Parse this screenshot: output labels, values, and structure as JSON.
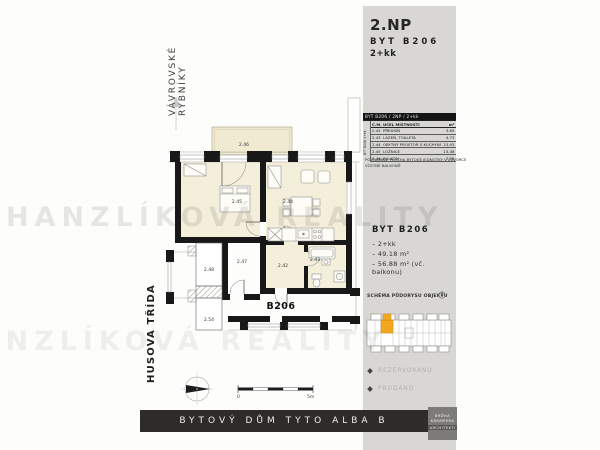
{
  "watermark": {
    "text": "HANZLÍKOVÁ REALITY"
  },
  "left": {
    "street_line1": "VÁVROVSKÉ",
    "street_line2": "RYBNÍKY",
    "street_bottom": "HUSOVA TŘÍDA"
  },
  "plan": {
    "unit_label": "B206",
    "labels": {
      "balcony": "2.46",
      "bedroom": "2.45",
      "living": "2.44",
      "hall": "2.42",
      "bath": "2.43",
      "neighbor1": "2.47",
      "neighbor2": "2.48",
      "neighbor3": "2.54"
    },
    "scale_start": "0",
    "scale_end": "5m"
  },
  "panel": {
    "floor": "2.NP",
    "unit": "BYT B206",
    "layout": "2+kk",
    "table": {
      "header_bar": "BYT B206 / 2NP / 2+kk",
      "side_label": "BYT B206 2+kk",
      "columns": {
        "num": "Č.M.",
        "name": "ÚČEL MÍSTNOSTI",
        "area": "m²"
      },
      "rows": [
        {
          "num": "2.42",
          "name": "PŘEDSÍŇ",
          "area": "3.85"
        },
        {
          "num": "2.43",
          "name": "LÁZEŇ, TOALETA",
          "area": "4.73"
        },
        {
          "num": "2.44",
          "name": "OBYTNÝ PROSTOR S KUCHYNÍ",
          "area": "23.92"
        },
        {
          "num": "2.45",
          "name": "LOŽNICE",
          "area": "13.48"
        },
        {
          "num": "2.46",
          "name": "BALKON",
          "area": "7.70"
        }
      ],
      "note1": "POZNÁMKA: PLOCHA BYTOVÉ JEDNOTKY V ZÁVORCE",
      "note2": "VČETNĚ BALKONŮ"
    },
    "summary": {
      "title": "BYT B206",
      "items": [
        "– 2+kk",
        "– 49.18 m²",
        "– 56.88 m² (vč. balkonu)"
      ]
    },
    "schema_title": "SCHÉMA PŮDORYSU OBJEKTU",
    "legend": [
      {
        "label": "REZERVOVÁNO"
      },
      {
        "label": "PRODÁNO"
      }
    ]
  },
  "footer": {
    "title": "BYTOVÝ DŮM TYTO ALBA B",
    "logo": [
      "BRŮHA",
      "KRAMPERA",
      "ARCHITEKTI"
    ]
  },
  "colors": {
    "accent_orange": "#f3a71e",
    "panel_bg": "#d8d7d4",
    "room_fill": "#f4efda",
    "footer_bg": "#2e2c29"
  }
}
